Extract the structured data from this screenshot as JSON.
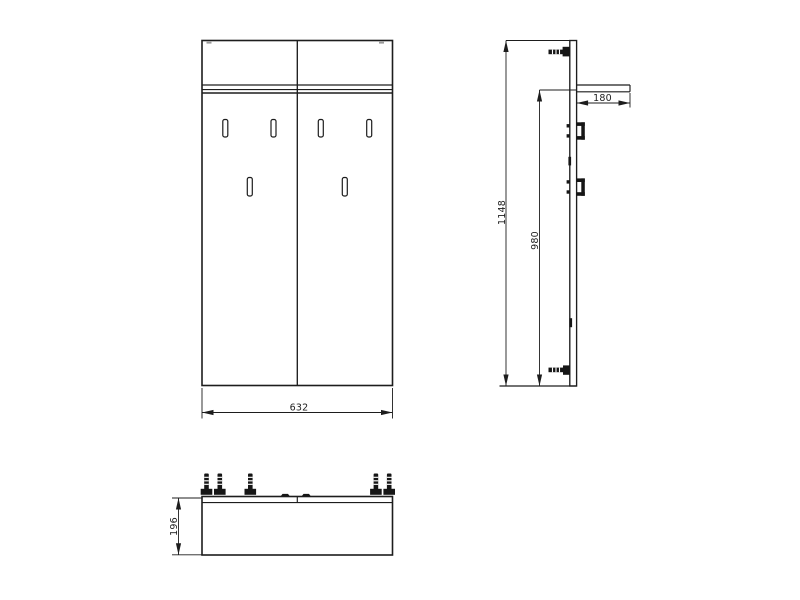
{
  "colors": {
    "background": "#ffffff",
    "line": "#1d1d1d"
  },
  "views": {
    "front": {
      "width_dim": "632"
    },
    "side": {
      "total_height_dim": "1148",
      "inner_height_dim": "980",
      "shelf_depth_dim": "180"
    },
    "top": {
      "depth_dim": "196"
    }
  }
}
